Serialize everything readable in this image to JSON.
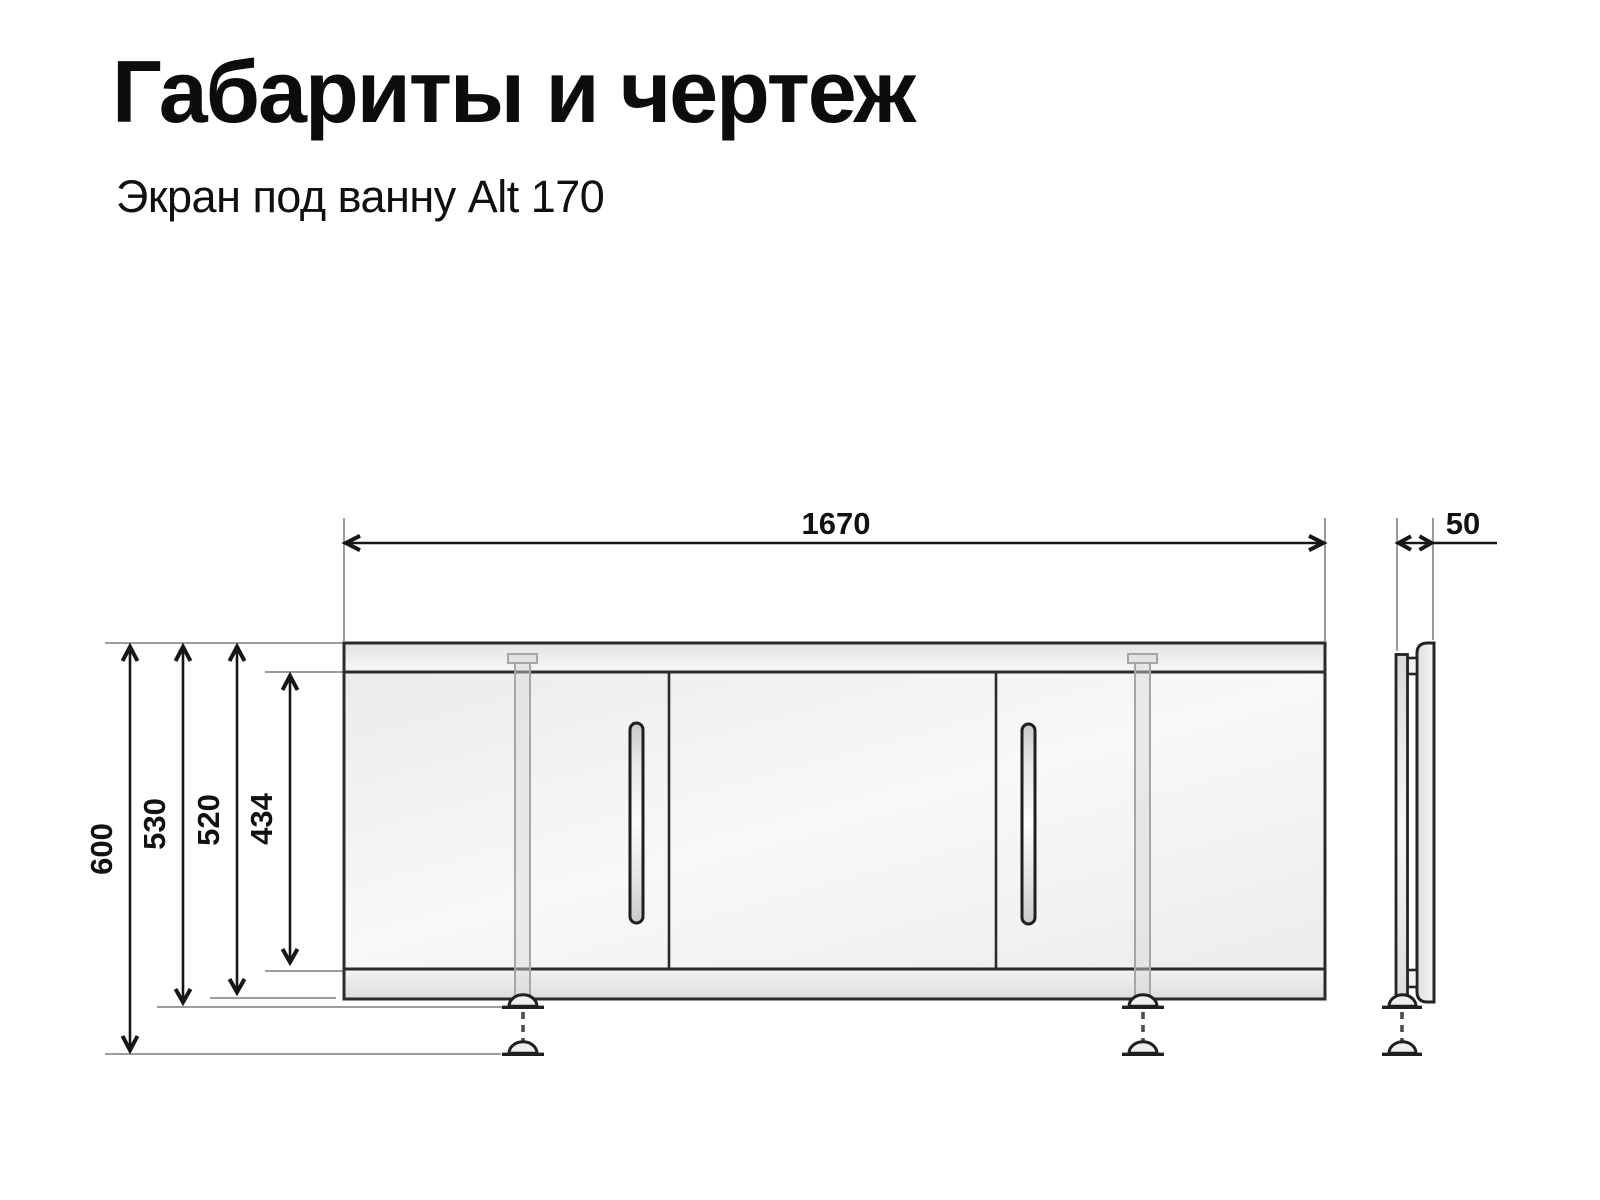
{
  "header": {
    "title": "Габариты и чертеж",
    "subtitle": "Экран под ванну Alt 170"
  },
  "dimensions": {
    "width": "1670",
    "height_max": "600",
    "height_feet_retracted": "530",
    "panel_height": "520",
    "door_height": "434",
    "depth": "50"
  },
  "drawing": {
    "units": "mm",
    "views": [
      "front",
      "side"
    ],
    "front_view": {
      "door_sections": 3,
      "handles": 2,
      "adjustable_legs": 2
    }
  }
}
